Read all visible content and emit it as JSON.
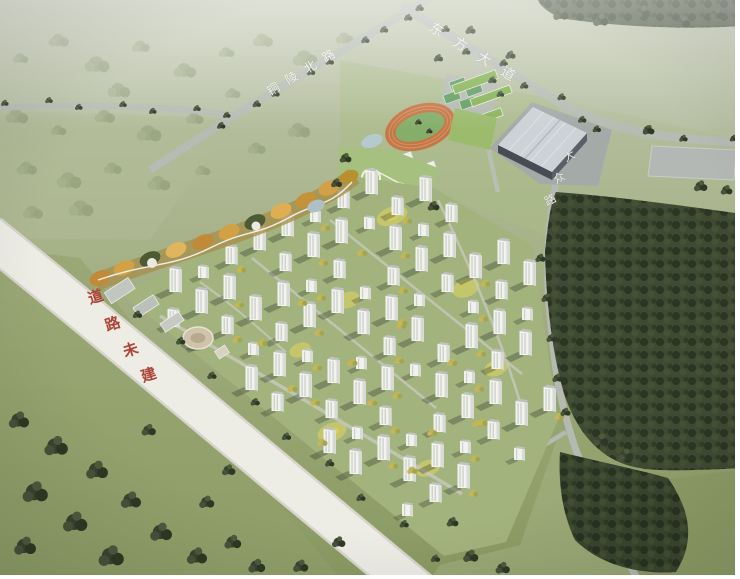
{
  "labels": {
    "road_tongling": "铜陵北路",
    "road_dongfang": "东方大道",
    "road_east_chars": [
      "大",
      "众",
      "路"
    ],
    "road_unbuilt_chars": [
      "道",
      "路",
      "未",
      "建"
    ]
  },
  "colors": {
    "label_white": "#eff1e9",
    "label_red": "#ae4437",
    "track": "#c57847",
    "track_infield": "#85ae6b",
    "factory_roof": "#cdd2d7",
    "unbuilt_road": "#edece5",
    "road": "#b6bbb3",
    "forest": "#3e4a33",
    "field": "#a9b488",
    "building_face": "#f2f3ef",
    "autumn_ribbon": "#cfa04a"
  }
}
